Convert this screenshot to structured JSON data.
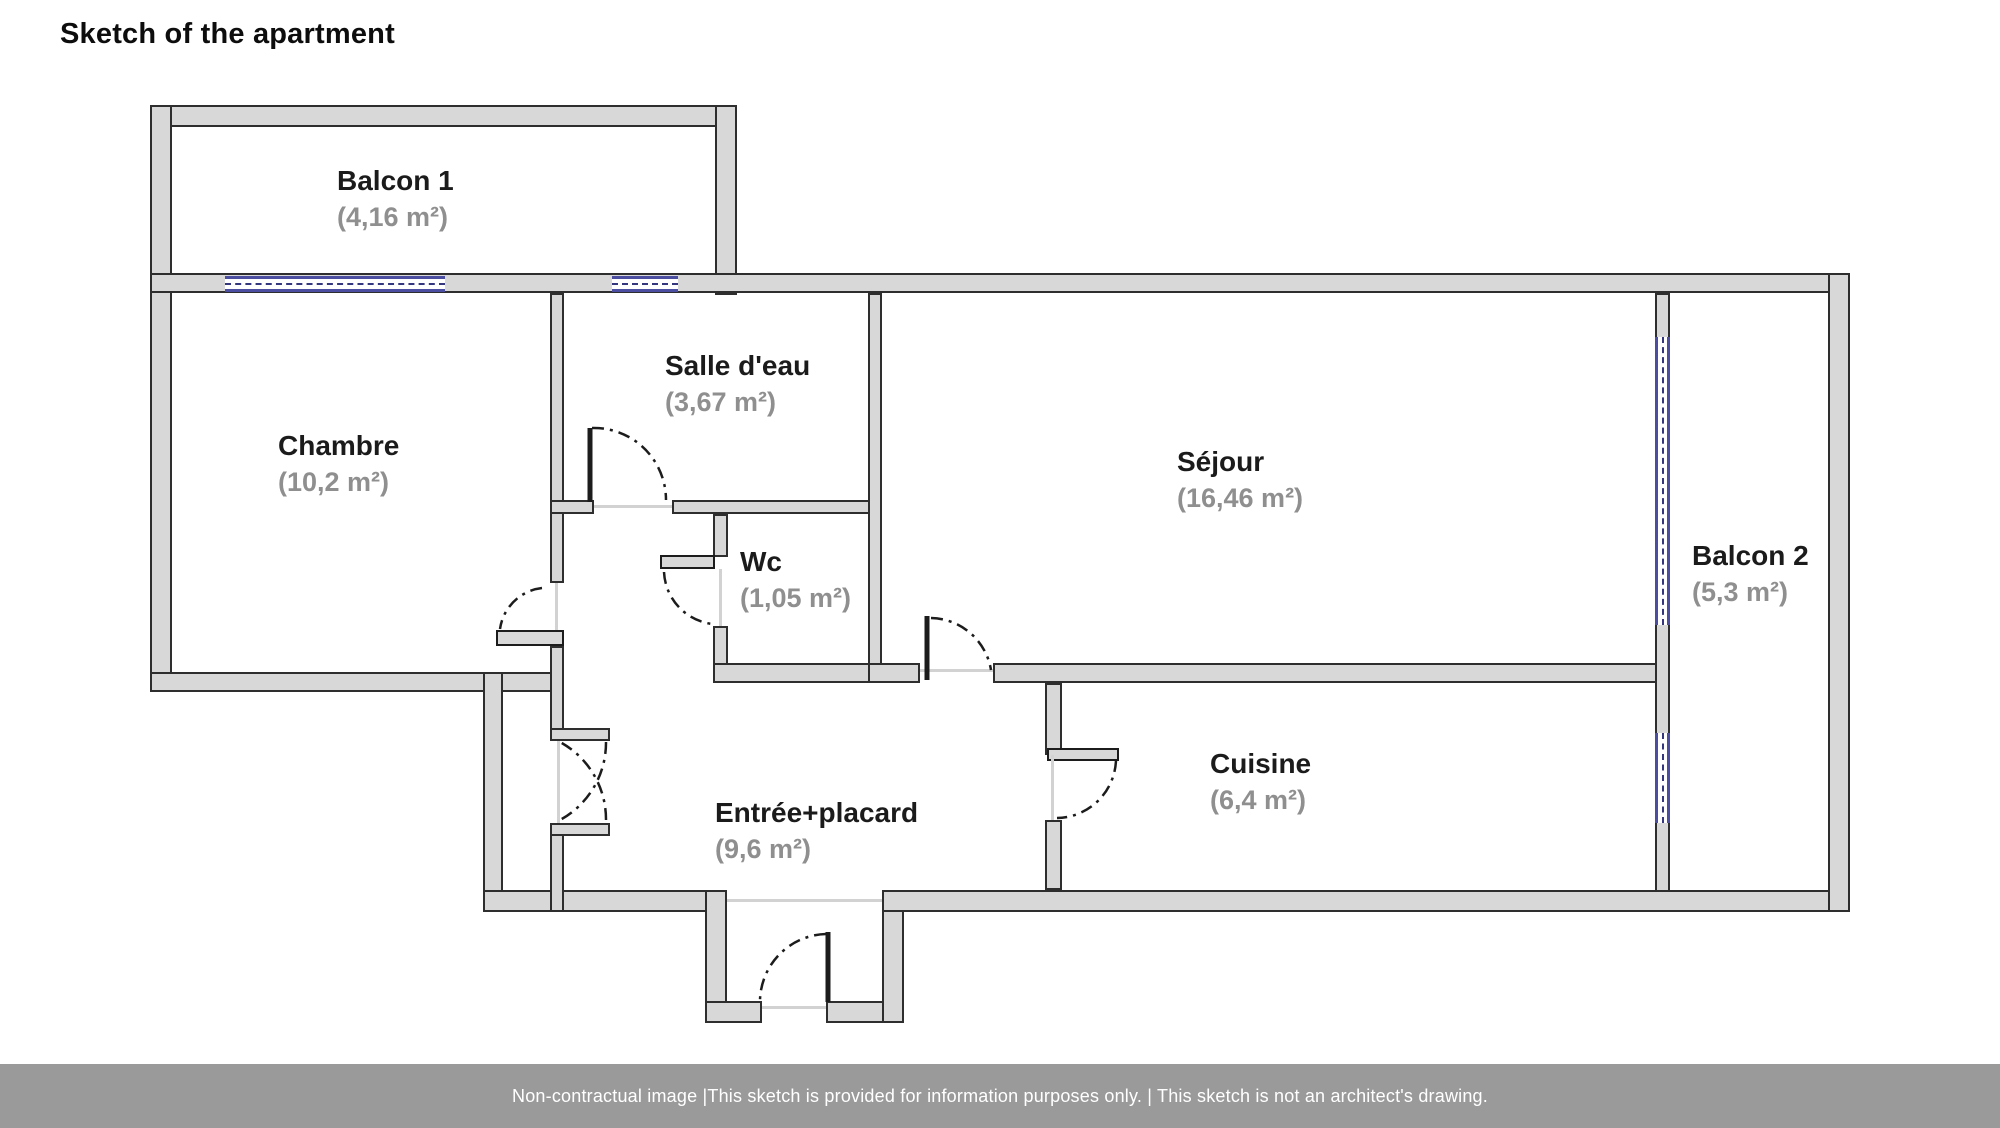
{
  "title": "Sketch of the apartment",
  "rooms": [
    {
      "id": "balcon1",
      "name": "Balcon 1",
      "area": "(4,16 m²)"
    },
    {
      "id": "chambre",
      "name": "Chambre",
      "area": "(10,2 m²)"
    },
    {
      "id": "salledeau",
      "name": "Salle d'eau",
      "area": "(3,67 m²)"
    },
    {
      "id": "wc",
      "name": "Wc",
      "area": "(1,05 m²)"
    },
    {
      "id": "sejour",
      "name": "Séjour",
      "area": "(16,46 m²)"
    },
    {
      "id": "balcon2",
      "name": "Balcon 2",
      "area": "(5,3 m²)"
    },
    {
      "id": "cuisine",
      "name": "Cuisine",
      "area": "(6,4 m²)"
    },
    {
      "id": "entree",
      "name": "Entrée+placard",
      "area": "(9,6 m²)"
    }
  ],
  "footer": {
    "text": "Non-contractual image |This sketch is provided for information purposes only. | This sketch is not an architect's drawing."
  },
  "colors": {
    "wall_fill": "#d8d8d8",
    "wall_stroke": "#2e2e2e",
    "window_blue": "#4a4da0",
    "label_gray": "#8f8f8f",
    "footer_bg": "#9a9a9a"
  }
}
